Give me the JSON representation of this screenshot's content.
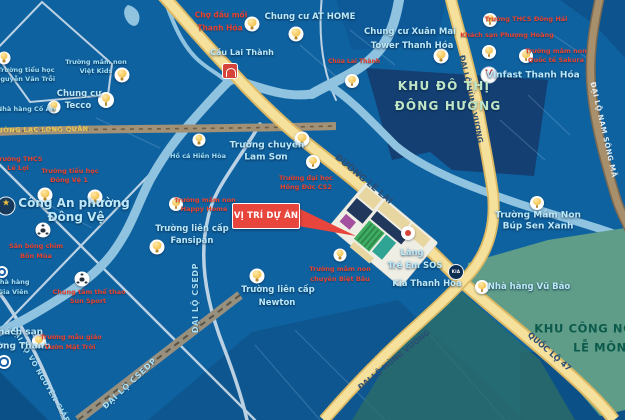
{
  "colors": {
    "map_bg": "#0f62a0",
    "water": "#8fc3e0",
    "label_cyan": "#a5dff5",
    "label_red": "#e8432f",
    "road_label": "#2a4d74",
    "gold_label": "#eac851",
    "callout_red": "#e8453c",
    "zone_city_text": "#bfe6c6",
    "zone_industrial_text": "#0c5a4b",
    "road_fill": "#f5e09c",
    "road_edge": "#dbb863",
    "green_zone": "#5f9d89"
  },
  "callout": {
    "label": "VỊ TRÍ DỰ ÁN"
  },
  "zones": [
    {
      "id": "khu-do-thi-dong-huong",
      "style": "zone-a",
      "fs": 12,
      "lines": [
        {
          "t": "KHU ĐÔ THỊ",
          "x": 444,
          "y": 86
        },
        {
          "t": "ĐÔNG HƯƠNG",
          "x": 448,
          "y": 106
        }
      ]
    },
    {
      "id": "khu-cong-nghiep-le-mon",
      "style": "zone-b",
      "fs": 11.5,
      "lines": [
        {
          "t": "KHU CÔNG NGHIỆP",
          "x": 600,
          "y": 329
        },
        {
          "t": "LỄ MÔN",
          "x": 600,
          "y": 348
        }
      ]
    }
  ],
  "road_labels": [
    {
      "id": "duong-lac-long-quan",
      "text": "ĐƯỜNG LẠC LONG QUÂN",
      "x": 40,
      "y": 130,
      "rot": -1,
      "style": "gold",
      "fs": 6.5
    },
    {
      "id": "duong-le-lai",
      "text": "ĐƯỜNG LÊ LAI",
      "x": 363,
      "y": 180,
      "rot": 40,
      "style": "navy",
      "fs": 9
    },
    {
      "id": "dai-lo-hung-vuong-north",
      "text": "ĐẠI LỘ HÙNG VƯƠNG",
      "x": 471,
      "y": 99,
      "rot": 78,
      "style": "navy",
      "fs": 7.5
    },
    {
      "id": "dai-lo-hung-vuong-south",
      "text": "ĐẠI LỘ HÙNG VƯƠNG",
      "x": 394,
      "y": 360,
      "rot": -39,
      "style": "navy",
      "fs": 7.5
    },
    {
      "id": "quoc-lo-47",
      "text": "QUỐC LỘ 47",
      "x": 549,
      "y": 352,
      "rot": 41,
      "style": "navy",
      "fs": 8
    },
    {
      "id": "dai-lo-nam-song-ma",
      "text": "ĐẠI LỘ NAM SÔNG MÃ",
      "x": 603,
      "y": 130,
      "rot": 77,
      "style": "pale",
      "fs": 7
    },
    {
      "id": "dai-lo-csedp-vertical",
      "text": "ĐẠI LỘ CSEDP",
      "x": 196,
      "y": 298,
      "rot": -90,
      "style": "cyanroad",
      "fs": 8
    },
    {
      "id": "dai-lo-csedp-diagonal",
      "text": "ĐẠI LỘ CSEDP",
      "x": 130,
      "y": 384,
      "rot": -43,
      "style": "cyanroad",
      "fs": 8
    },
    {
      "id": "dai-lo-vo-nguyen-giap",
      "text": "ĐẠI LỘ VÕ NGUYÊN GIÁP",
      "x": 40,
      "y": 375,
      "rot": 60,
      "style": "cyanroad",
      "fs": 7
    }
  ],
  "places": [
    {
      "id": "truong-tieu-hoc-nguyen-van-troi",
      "style": "cyan",
      "fs": 6.5,
      "lines": [
        {
          "t": "Trường tiểu học",
          "x": 26,
          "y": 70
        },
        {
          "t": "Nguyễn Văn Trỗi",
          "x": 25,
          "y": 79
        }
      ],
      "icon": {
        "type": "bulb",
        "x": 4,
        "y": 58,
        "s": 13
      }
    },
    {
      "id": "truong-mam-non-viet-kids",
      "style": "cyan",
      "fs": 6.5,
      "lines": [
        {
          "t": "Trường mầm non",
          "x": 96,
          "y": 62
        },
        {
          "t": "Việt Kids",
          "x": 96,
          "y": 71
        }
      ],
      "icon": {
        "type": "bulb",
        "x": 122,
        "y": 75,
        "s": 15
      }
    },
    {
      "id": "chung-cu-tecco",
      "style": "cyan-strong",
      "fs": 8.5,
      "lines": [
        {
          "t": "Chung cư",
          "x": 79,
          "y": 94
        },
        {
          "t": "Tecco",
          "x": 78,
          "y": 106
        }
      ],
      "icon": {
        "type": "bulb",
        "x": 106,
        "y": 100,
        "s": 16
      }
    },
    {
      "id": "nha-hang-co-an",
      "style": "cyan",
      "fs": 6.5,
      "lines": [
        {
          "t": "Nhà hàng Cố Ẩn",
          "x": 26,
          "y": 109
        }
      ],
      "icon": {
        "type": "bulb",
        "x": 54,
        "y": 107,
        "s": 13
      }
    },
    {
      "id": "cho-dau-moi-thanh-hoa",
      "style": "red",
      "fs": 7.5,
      "lines": [
        {
          "t": "Chợ đầu mối",
          "x": 221,
          "y": 15
        },
        {
          "t": "Thanh Hóa",
          "x": 220,
          "y": 28
        }
      ],
      "icon": {
        "type": "bulb",
        "x": 252,
        "y": 24,
        "s": 15
      }
    },
    {
      "id": "chung-cu-at-home",
      "style": "cyan-strong",
      "fs": 8.5,
      "lines": [
        {
          "t": "Chung cư AT HOME",
          "x": 310,
          "y": 17
        }
      ],
      "icon": {
        "type": "bulb",
        "x": 296,
        "y": 34,
        "s": 15
      }
    },
    {
      "id": "cau-lai-thanh",
      "style": "cyan-strong",
      "fs": 8,
      "lines": [
        {
          "t": "Cầu Lai Thành",
          "x": 242,
          "y": 53
        }
      ],
      "icon": {
        "type": "bridge",
        "x": 230,
        "y": 71,
        "s": 14
      }
    },
    {
      "id": "chua-lai-thanh",
      "style": "red",
      "fs": 6,
      "lines": [
        {
          "t": "Chùa Lai Thành",
          "x": 354,
          "y": 62
        }
      ],
      "icon": {
        "type": "bulb",
        "x": 352,
        "y": 81,
        "s": 14
      }
    },
    {
      "id": "chung-cu-xuan-mai",
      "style": "cyan-strong",
      "fs": 8.5,
      "lines": [
        {
          "t": "Chung cư Xuân Mai",
          "x": 410,
          "y": 32
        },
        {
          "t": "Tower Thanh Hóa",
          "x": 412,
          "y": 46
        }
      ],
      "icon": {
        "type": "bulb",
        "x": 441,
        "y": 56,
        "s": 15
      }
    },
    {
      "id": "truong-thcs-dong-hai",
      "style": "red",
      "fs": 6.5,
      "lines": [
        {
          "t": "Trường THCS Đông Hải",
          "x": 526,
          "y": 19
        }
      ],
      "icon": {
        "type": "bulb",
        "x": 490,
        "y": 20,
        "s": 14
      }
    },
    {
      "id": "khach-san-phuong-hoang",
      "style": "red",
      "fs": 6.5,
      "lines": [
        {
          "t": "Khách sạn Phượng Hoàng",
          "x": 507,
          "y": 35
        }
      ],
      "icon": {
        "type": "bulb",
        "x": 489,
        "y": 52,
        "s": 14
      }
    },
    {
      "id": "truong-mam-non-quoc-te-sakura",
      "style": "red",
      "fs": 6.5,
      "lines": [
        {
          "t": "Trường mầm non",
          "x": 556,
          "y": 51
        },
        {
          "t": "Quốc tế Sakura",
          "x": 556,
          "y": 60
        }
      ],
      "icon": {
        "type": "bulb",
        "x": 526,
        "y": 56,
        "s": 14
      }
    },
    {
      "id": "vinfast-thanh-hoa",
      "style": "cyan-strong",
      "fs": 9,
      "lines": [
        {
          "t": "Vinfast Thanh Hóa",
          "x": 533,
          "y": 76
        }
      ],
      "icon": {
        "type": "vinfast",
        "x": 489,
        "y": 75,
        "s": 15
      }
    },
    {
      "id": "truong-chuyen-lam-son",
      "style": "cyan-strong",
      "fs": 9,
      "lines": [
        {
          "t": "Trường chuyên",
          "x": 267,
          "y": 146
        },
        {
          "t": "Lam Sơn",
          "x": 266,
          "y": 158
        }
      ],
      "icon": {
        "type": "bulb",
        "x": 302,
        "y": 139,
        "s": 15
      }
    },
    {
      "id": "truong-dai-hoc-hong-duc-cs2",
      "style": "red",
      "fs": 6.5,
      "lines": [
        {
          "t": "Trường đại học",
          "x": 306,
          "y": 178
        },
        {
          "t": "Hồng Đức CS2",
          "x": 306,
          "y": 187
        }
      ],
      "icon": {
        "type": "bulb",
        "x": 313,
        "y": 162,
        "s": 14
      }
    },
    {
      "id": "ho-ca-hien-hoa",
      "style": "cyan",
      "fs": 6.5,
      "lines": [
        {
          "t": "Hồ cá Hiền Hòa",
          "x": 198,
          "y": 156
        }
      ],
      "icon": {
        "type": "bulb",
        "x": 199,
        "y": 140,
        "s": 13
      }
    },
    {
      "id": "truong-thcs-le-loi",
      "style": "red",
      "fs": 6.5,
      "lines": [
        {
          "t": "Trường THCS",
          "x": 19,
          "y": 159
        },
        {
          "t": "Lê Lợi",
          "x": 18,
          "y": 168
        }
      ]
    },
    {
      "id": "truong-tieu-hoc-dong-ve-1",
      "style": "red",
      "fs": 6.5,
      "lines": [
        {
          "t": "Trường tiểu học",
          "x": 70,
          "y": 171
        },
        {
          "t": "Đông Vệ 1",
          "x": 69,
          "y": 180
        }
      ]
    },
    {
      "id": "cong-an-phuong-dong-ve",
      "style": "cyan-strong",
      "fs": 12,
      "lines": [
        {
          "t": "Công An phường",
          "x": 74,
          "y": 203
        },
        {
          "t": "Đông Vệ",
          "x": 76,
          "y": 217
        }
      ],
      "icon": {
        "type": "police",
        "x": 6,
        "y": 206,
        "s": 17
      }
    },
    {
      "id": "san-bong-chim-bon-mua",
      "style": "red",
      "fs": 6.5,
      "lines": [
        {
          "t": "Sân bóng chim",
          "x": 36,
          "y": 246
        },
        {
          "t": "Bốn Mùa",
          "x": 36,
          "y": 256
        }
      ],
      "icon": {
        "type": "soccer",
        "x": 43,
        "y": 230,
        "s": 15
      }
    },
    {
      "id": "nha-hang-gia-vien",
      "style": "cyan",
      "fs": 6.5,
      "lines": [
        {
          "t": "Nhà hàng",
          "x": 12,
          "y": 282
        },
        {
          "t": "Gia Viên",
          "x": 13,
          "y": 292
        }
      ],
      "icon": {
        "type": "hotel",
        "x": 2,
        "y": 272,
        "s": 12
      }
    },
    {
      "id": "trung-tam-the-thao-sun-sport",
      "style": "red",
      "fs": 6.5,
      "lines": [
        {
          "t": "Chung tâm thể thao",
          "x": 89,
          "y": 292
        },
        {
          "t": "Sun Sport",
          "x": 88,
          "y": 301
        }
      ],
      "icon": {
        "type": "soccer",
        "x": 82,
        "y": 279,
        "s": 15
      }
    },
    {
      "id": "truong-lien-cap-fansipan",
      "style": "cyan-strong",
      "fs": 8.5,
      "lines": [
        {
          "t": "Trường liên cấp",
          "x": 192,
          "y": 229
        },
        {
          "t": "Fansipan",
          "x": 192,
          "y": 241
        }
      ],
      "icon": {
        "type": "bulb",
        "x": 157,
        "y": 247,
        "s": 15
      }
    },
    {
      "id": "truong-mam-non-happy-home",
      "style": "red",
      "fs": 6.5,
      "lines": [
        {
          "t": "Trường mầm non",
          "x": 205,
          "y": 200
        },
        {
          "t": "Happy Home",
          "x": 204,
          "y": 209
        }
      ],
      "icon": {
        "type": "bulb",
        "x": 176,
        "y": 204,
        "s": 14
      }
    },
    {
      "id": "khach-san-muong-thanh",
      "style": "cyan-strong",
      "fs": 9,
      "lines": [
        {
          "t": "Khách sạn",
          "x": 17,
          "y": 333
        },
        {
          "t": "Mường Thanh",
          "x": 16,
          "y": 347
        }
      ],
      "icon": {
        "type": "hotel",
        "x": 4,
        "y": 362,
        "s": 14
      }
    },
    {
      "id": "truong-mau-giao-vuon-mat-troi",
      "style": "red",
      "fs": 6.5,
      "lines": [
        {
          "t": "Trường mẫu giáo",
          "x": 71,
          "y": 337
        },
        {
          "t": "Vườn Mặt Trời",
          "x": 70,
          "y": 347
        }
      ],
      "icon": {
        "type": "bulb",
        "x": 39,
        "y": 341,
        "s": 14
      }
    },
    {
      "id": "truong-lien-cap-newton",
      "style": "cyan-strong",
      "fs": 8.5,
      "lines": [
        {
          "t": "Trường liên cấp",
          "x": 278,
          "y": 290
        },
        {
          "t": "Newton",
          "x": 277,
          "y": 303
        }
      ],
      "icon": {
        "type": "bulb",
        "x": 257,
        "y": 276,
        "s": 15
      }
    },
    {
      "id": "truong-mam-non-biet-bau",
      "style": "red",
      "fs": 6.5,
      "lines": [
        {
          "t": "Trường mầm non",
          "x": 340,
          "y": 269
        },
        {
          "t": "chuyên Biệt Bầu",
          "x": 340,
          "y": 279
        }
      ],
      "icon": {
        "type": "bulb",
        "x": 340,
        "y": 255,
        "s": 13
      }
    },
    {
      "id": "lang-tre-em-sos",
      "style": "cyan-strong",
      "fs": 8.5,
      "lines": [
        {
          "t": "Làng",
          "x": 412,
          "y": 253
        },
        {
          "t": "Trẻ Em SOS",
          "x": 415,
          "y": 266
        }
      ],
      "icon": {
        "type": "sos",
        "x": 408,
        "y": 233,
        "s": 14
      }
    },
    {
      "id": "kia-thanh-hoa",
      "style": "cyan-strong",
      "fs": 8.5,
      "lines": [
        {
          "t": "Kia Thanh Hóa",
          "x": 427,
          "y": 284
        }
      ],
      "icon": {
        "type": "kia",
        "x": 456,
        "y": 272,
        "s": 14
      }
    },
    {
      "id": "nha-hang-vu-bao",
      "style": "cyan-strong",
      "fs": 8.5,
      "lines": [
        {
          "t": "Nhà hàng Vũ Bảo",
          "x": 529,
          "y": 287
        }
      ],
      "icon": {
        "type": "bulb",
        "x": 482,
        "y": 287,
        "s": 14
      }
    },
    {
      "id": "truong-mam-non-bup-sen-xanh",
      "style": "cyan-strong",
      "fs": 9,
      "lines": [
        {
          "t": "Trường Mầm Non",
          "x": 538,
          "y": 216
        },
        {
          "t": "Búp Sen Xanh",
          "x": 538,
          "y": 227
        }
      ],
      "icon": {
        "type": "bulb",
        "x": 537,
        "y": 203,
        "s": 14
      }
    }
  ],
  "markers": [
    {
      "type": "bulb",
      "x": 45,
      "y": 195,
      "s": 15
    },
    {
      "type": "bulb",
      "x": 95,
      "y": 197,
      "s": 15
    }
  ]
}
